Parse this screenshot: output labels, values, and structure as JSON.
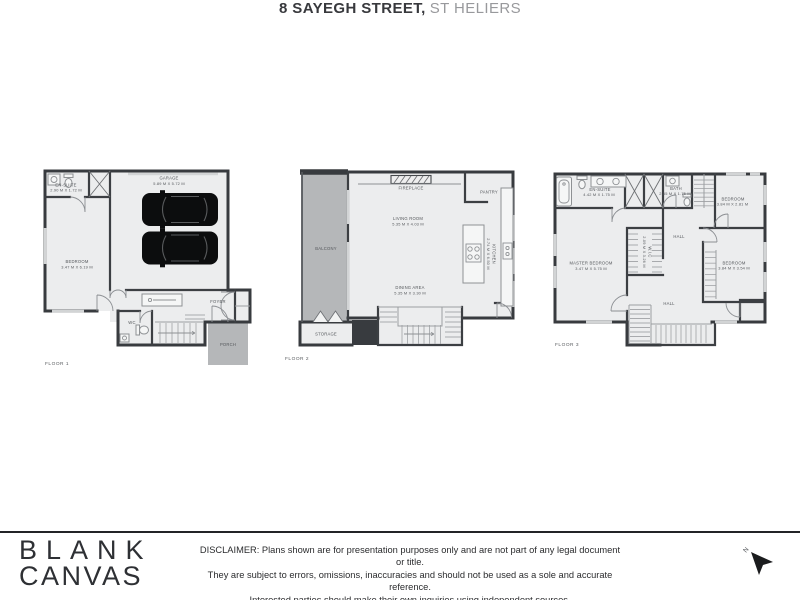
{
  "title": {
    "address": "8 SAYEGH STREET,",
    "suburb": "ST HELIERS"
  },
  "logo": {
    "line1": "BLANK",
    "line2": "CANVAS"
  },
  "disclaimer": {
    "line1": "DISCLAIMER: Plans shown are for presentation purposes only and are not part of any legal document or title.",
    "line2": "They are subject to errors, omissions, inaccuracies and should not be used as a sole and accurate reference.",
    "line3": "Interested parties should make their own inquiries using independent sources."
  },
  "compass": {
    "label": "N"
  },
  "colors": {
    "wall": "#383b3f",
    "floor": "#ecedee",
    "outdoor_gray": "#b5b7b9",
    "car": "#0c0d0e"
  },
  "floors": [
    {
      "label": "FLOOR 1",
      "rooms": {
        "ensuite": {
          "name": "EN-SUITE",
          "dims": "2.90 M X 1.72 M"
        },
        "garage": {
          "name": "GARAGE",
          "dims": "5.89 M X 5.72 M"
        },
        "bedroom": {
          "name": "BEDROOM",
          "dims": "3.47 M X 6.19 M"
        },
        "foyer": {
          "name": "FOYER"
        },
        "wc": {
          "name": "WC"
        },
        "porch": {
          "name": "PORCH"
        }
      }
    },
    {
      "label": "FLOOR 2",
      "rooms": {
        "fireplace": {
          "name": "FIREPLACE"
        },
        "pantry": {
          "name": "PANTRY"
        },
        "living": {
          "name": "LIVING ROOM",
          "dims": "5.35 M X 4.03 M"
        },
        "balcony": {
          "name": "BALCONY"
        },
        "kitchen": {
          "name": "KITCHEN",
          "dims": "2.74 M X 6.50 M"
        },
        "dining": {
          "name": "DINING AREA",
          "dims": "5.35 M X 3.30 M"
        },
        "storage": {
          "name": "STORAGE"
        }
      }
    },
    {
      "label": "FLOOR 3",
      "rooms": {
        "ensuite": {
          "name": "EN-SUITE",
          "dims": "4.42 M X 1.75 M"
        },
        "bath": {
          "name": "BATH",
          "dims": "2.55 M X 1.75 M"
        },
        "bedroom1": {
          "name": "BEDROOM",
          "dims": "3.84 M X 2.81 M"
        },
        "master": {
          "name": "MASTER BEDROOM",
          "dims": "3.47 M X 5.75 M"
        },
        "wic": {
          "name": "W.I.C",
          "dims": "2.09 M X 3.26 M"
        },
        "hall_upper": {
          "name": "HALL"
        },
        "bedroom2": {
          "name": "BEDROOM",
          "dims": "3.84 M X 3.54 M"
        },
        "hall_lower": {
          "name": "HALL"
        }
      }
    }
  ]
}
